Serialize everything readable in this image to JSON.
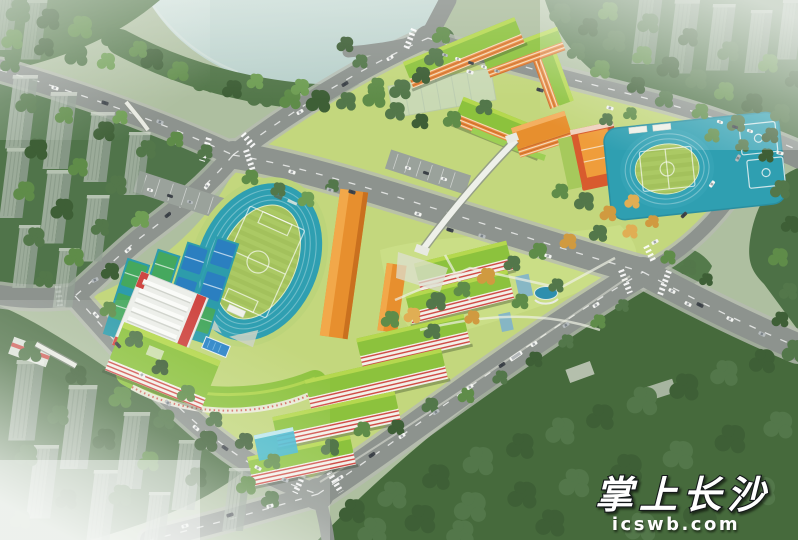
{
  "watermark": {
    "title": "掌上长沙",
    "domain": "icswb.com"
  },
  "palette": {
    "water": "#b7cfca",
    "campus-ground": "#c3d77d",
    "track-teal": "#2f9fb1",
    "field-green": "#a3c15c",
    "roof-green": "#8cc23d",
    "roof-green-edge": "#b5d84e",
    "facade-orange": "#e8873a",
    "roof-orange": "#e78f2e",
    "accent-red": "#cf4742",
    "gym-white": "#eceee9",
    "court-blue": "#2b7fc0",
    "court-green": "#45a85e",
    "court-pad": "#2d9cab",
    "road-gray": "#8d938e",
    "sidewalk-gray": "#b7bcb2",
    "tree-dark": "#3e5f36",
    "tree-mid": "#53774a",
    "tree-light": "#6f9e54",
    "autumn-orange": "#d09a40",
    "glass-blue": "#3fb6cf"
  }
}
